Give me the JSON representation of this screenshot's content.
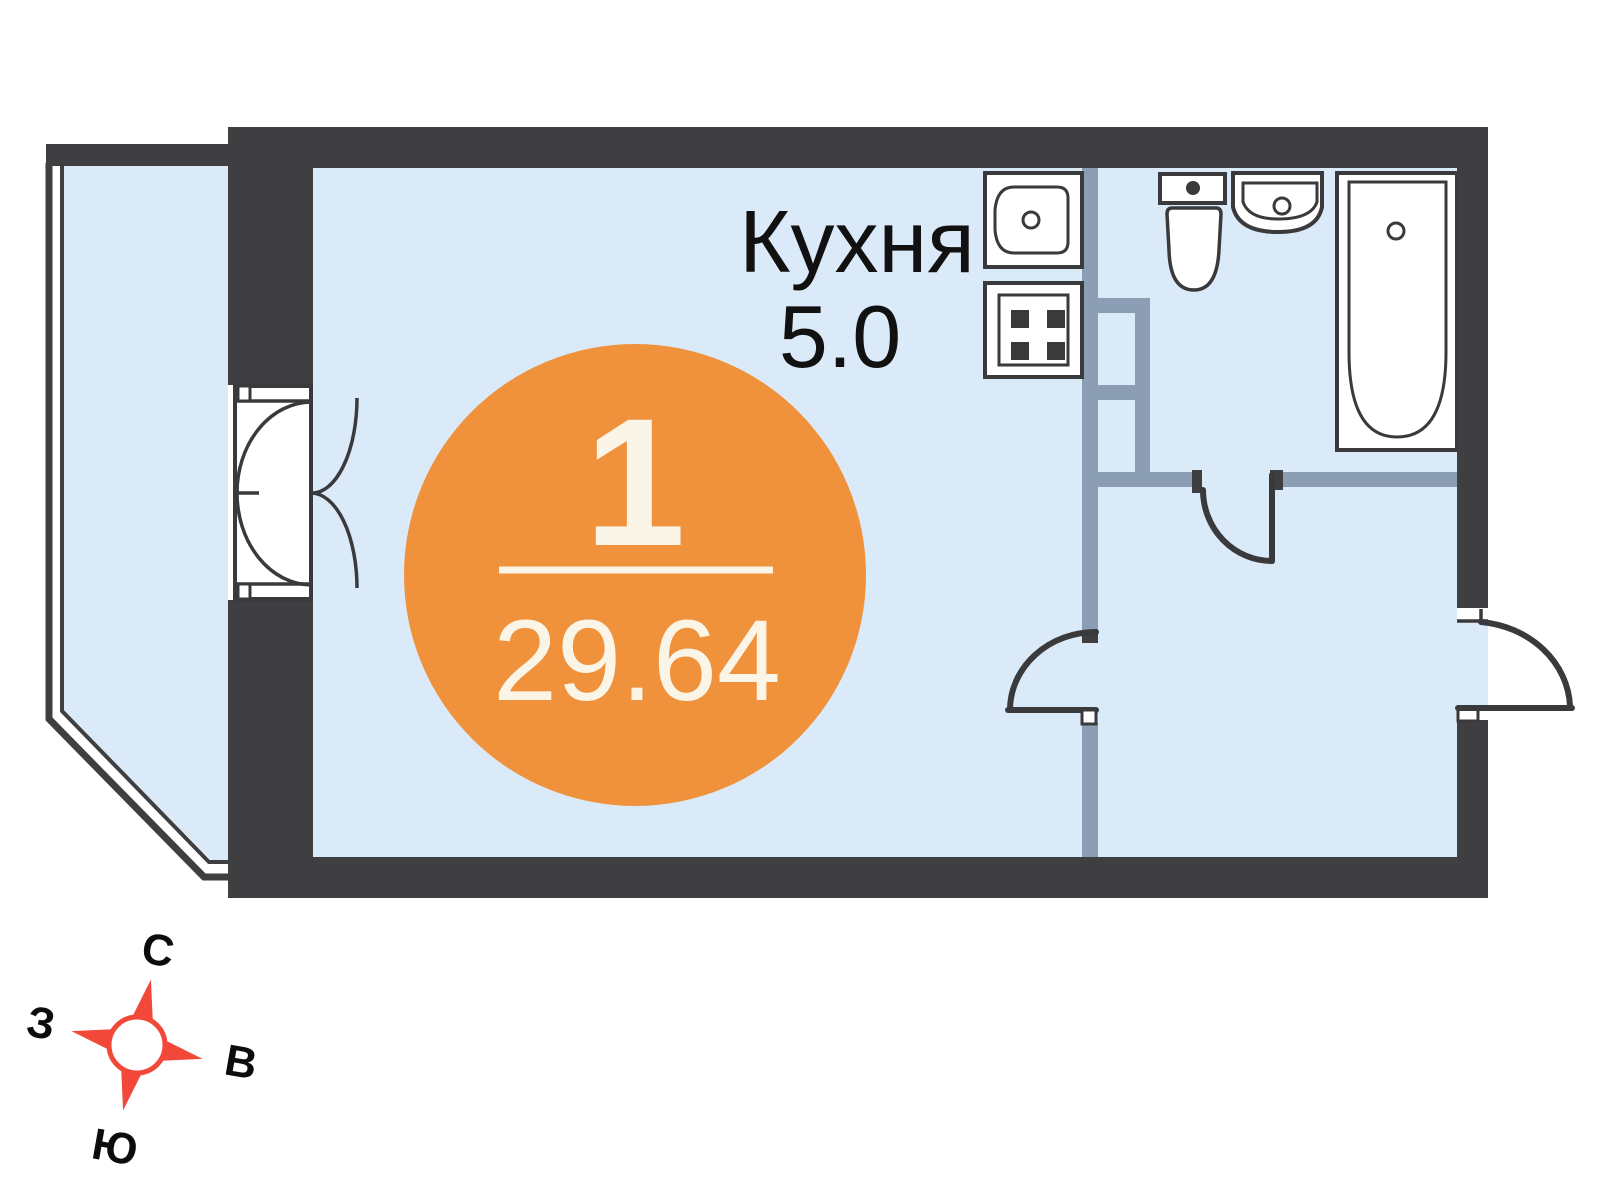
{
  "colors": {
    "background": "#ffffff",
    "wall": "#3f3f41",
    "line": "#3a3a3c",
    "partition": "#8c9eb4",
    "room": "#dbeaf8",
    "accent": "#f0913c",
    "badge_text": "#faf5e7",
    "compass_red": "#f2483a",
    "label": "#111111"
  },
  "plan": {
    "badge": {
      "rooms": "1",
      "area": "29.64"
    },
    "kitchen": {
      "name": "Кухня",
      "area": "5.0"
    },
    "compass": {
      "north": "С",
      "east": "В",
      "south": "Ю",
      "west": "З"
    }
  }
}
